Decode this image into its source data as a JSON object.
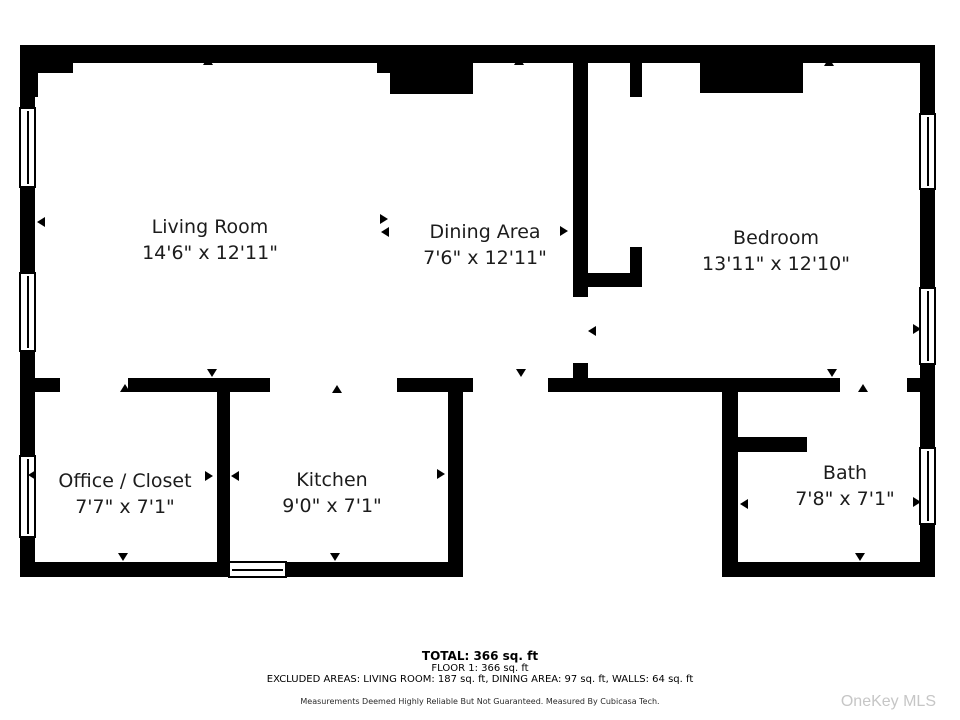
{
  "watermark": "OneKey MLS",
  "footer": {
    "total": "TOTAL: 366 sq. ft",
    "floor1": "FLOOR 1: 366 sq. ft",
    "excluded": "EXCLUDED AREAS: LIVING ROOM: 187 sq. ft, DINING AREA: 97 sq. ft, WALLS: 64 sq. ft",
    "disclaimer": "Measurements Deemed Highly Reliable But Not Guaranteed. Measured By Cubicasa Tech."
  },
  "rooms": [
    {
      "id": "living-room",
      "name": "Living Room",
      "dims": "14'6\" x 12'11\"",
      "cx": 210,
      "cy": 240
    },
    {
      "id": "dining-area",
      "name": "Dining Area",
      "dims": "7'6\" x 12'11\"",
      "cx": 485,
      "cy": 245
    },
    {
      "id": "bedroom",
      "name": "Bedroom",
      "dims": "13'11\" x 12'10\"",
      "cx": 776,
      "cy": 251
    },
    {
      "id": "office-closet",
      "name": "Office / Closet",
      "dims": "7'7\" x 7'1\"",
      "cx": 125,
      "cy": 494
    },
    {
      "id": "kitchen",
      "name": "Kitchen",
      "dims": "9'0\" x 7'1\"",
      "cx": 332,
      "cy": 493
    },
    {
      "id": "bath",
      "name": "Bath",
      "dims": "7'8\" x 7'1\"",
      "cx": 845,
      "cy": 486
    }
  ],
  "plan": {
    "wall_color": "#000000",
    "walls": [
      {
        "n": "outer-top",
        "x": 20,
        "y": 45,
        "w": 915,
        "h": 18
      },
      {
        "n": "outer-left",
        "x": 20,
        "y": 45,
        "w": 15,
        "h": 532
      },
      {
        "n": "outer-right",
        "x": 920,
        "y": 45,
        "w": 15,
        "h": 532
      },
      {
        "n": "outer-bottom-left",
        "x": 20,
        "y": 562,
        "w": 443,
        "h": 15
      },
      {
        "n": "outer-bottom-right",
        "x": 722,
        "y": 562,
        "w": 213,
        "h": 15
      },
      {
        "n": "topleft-step-a",
        "x": 20,
        "y": 63,
        "w": 18,
        "h": 34
      },
      {
        "n": "topleft-step-b",
        "x": 38,
        "y": 63,
        "w": 35,
        "h": 10
      },
      {
        "n": "block-living-step",
        "x": 377,
        "y": 63,
        "w": 13,
        "h": 10
      },
      {
        "n": "block-living-dining",
        "x": 390,
        "y": 63,
        "w": 83,
        "h": 31
      },
      {
        "n": "block-bedroom-closet",
        "x": 700,
        "y": 63,
        "w": 103,
        "h": 30
      },
      {
        "n": "divider-dining-bedroom",
        "x": 573,
        "y": 63,
        "w": 15,
        "h": 234
      },
      {
        "n": "shaft-right-top",
        "x": 630,
        "y": 63,
        "w": 12,
        "h": 34
      },
      {
        "n": "shaft-right-bottom",
        "x": 630,
        "y": 247,
        "w": 12,
        "h": 40
      },
      {
        "n": "shaft-bottom",
        "x": 573,
        "y": 273,
        "w": 69,
        "h": 14
      },
      {
        "n": "divider-stub",
        "x": 573,
        "y": 363,
        "w": 15,
        "h": 15
      },
      {
        "n": "mid-wall-seg1",
        "x": 20,
        "y": 378,
        "w": 40,
        "h": 14
      },
      {
        "n": "mid-wall-seg2",
        "x": 128,
        "y": 378,
        "w": 142,
        "h": 14
      },
      {
        "n": "mid-wall-seg3",
        "x": 397,
        "y": 378,
        "w": 76,
        "h": 14
      },
      {
        "n": "mid-wall-seg4",
        "x": 548,
        "y": 378,
        "w": 292,
        "h": 14
      },
      {
        "n": "mid-wall-seg5",
        "x": 907,
        "y": 378,
        "w": 28,
        "h": 14
      },
      {
        "n": "office-kitchen-divider",
        "x": 217,
        "y": 392,
        "w": 13,
        "h": 170
      },
      {
        "n": "kitchen-right-wall",
        "x": 448,
        "y": 392,
        "w": 15,
        "h": 170
      },
      {
        "n": "bath-left-wall",
        "x": 722,
        "y": 392,
        "w": 16,
        "h": 170
      },
      {
        "n": "bath-partition",
        "x": 738,
        "y": 437,
        "w": 69,
        "h": 15
      }
    ],
    "windows": [
      {
        "n": "window-living-left-upper",
        "x": 19,
        "y": 107,
        "w": 17,
        "h": 81,
        "o": "v"
      },
      {
        "n": "window-living-left-lower",
        "x": 19,
        "y": 272,
        "w": 17,
        "h": 80,
        "o": "v"
      },
      {
        "n": "window-office-left",
        "x": 19,
        "y": 455,
        "w": 17,
        "h": 83,
        "o": "v"
      },
      {
        "n": "window-bedroom-right-upper",
        "x": 919,
        "y": 113,
        "w": 17,
        "h": 77,
        "o": "v"
      },
      {
        "n": "window-bedroom-right-lower",
        "x": 919,
        "y": 287,
        "w": 17,
        "h": 78,
        "o": "v"
      },
      {
        "n": "window-bath-right",
        "x": 919,
        "y": 447,
        "w": 17,
        "h": 78,
        "o": "v"
      },
      {
        "n": "window-kitchen-bottom",
        "x": 228,
        "y": 561,
        "w": 59,
        "h": 17,
        "o": "h"
      }
    ],
    "arrows": [
      {
        "x": 203,
        "y": 57,
        "d": "up"
      },
      {
        "x": 207,
        "y": 369,
        "d": "down"
      },
      {
        "x": 514,
        "y": 57,
        "d": "up"
      },
      {
        "x": 516,
        "y": 369,
        "d": "down"
      },
      {
        "x": 824,
        "y": 58,
        "d": "up"
      },
      {
        "x": 827,
        "y": 369,
        "d": "down"
      },
      {
        "x": 37,
        "y": 217,
        "d": "left"
      },
      {
        "x": 380,
        "y": 214,
        "d": "right"
      },
      {
        "x": 381,
        "y": 227,
        "d": "left"
      },
      {
        "x": 560,
        "y": 226,
        "d": "right"
      },
      {
        "x": 588,
        "y": 326,
        "d": "left"
      },
      {
        "x": 913,
        "y": 324,
        "d": "right"
      },
      {
        "x": 28,
        "y": 470,
        "d": "left"
      },
      {
        "x": 205,
        "y": 471,
        "d": "right"
      },
      {
        "x": 231,
        "y": 471,
        "d": "left"
      },
      {
        "x": 437,
        "y": 469,
        "d": "right"
      },
      {
        "x": 120,
        "y": 384,
        "d": "up"
      },
      {
        "x": 118,
        "y": 553,
        "d": "down"
      },
      {
        "x": 332,
        "y": 385,
        "d": "up"
      },
      {
        "x": 330,
        "y": 553,
        "d": "down"
      },
      {
        "x": 858,
        "y": 384,
        "d": "up"
      },
      {
        "x": 855,
        "y": 553,
        "d": "down"
      },
      {
        "x": 740,
        "y": 499,
        "d": "left"
      },
      {
        "x": 913,
        "y": 497,
        "d": "right"
      }
    ]
  }
}
